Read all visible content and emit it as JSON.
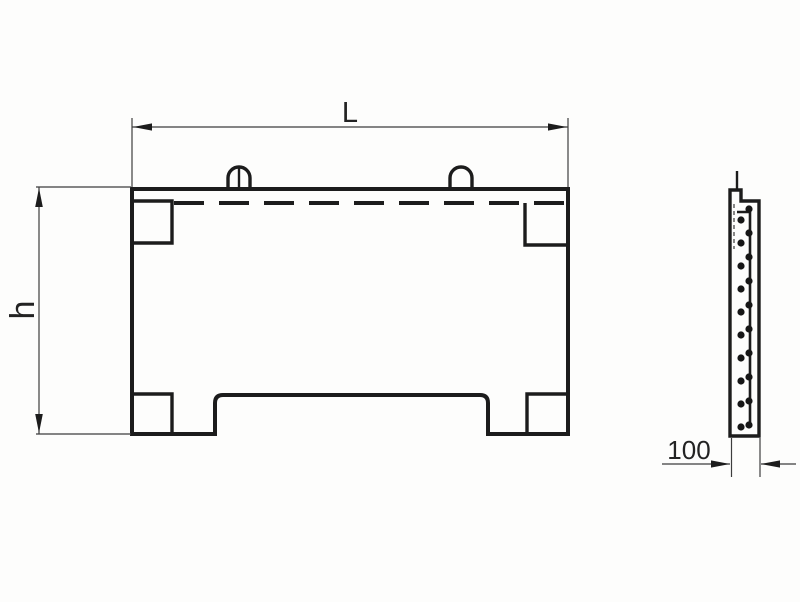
{
  "drawing": {
    "labels": {
      "length": "L",
      "height": "h",
      "width": "100"
    },
    "colors": {
      "line": "#1c1c1c",
      "dim_line": "#3d3d3d",
      "text": "#232323",
      "background": "#fdfdfc"
    },
    "side_view": {
      "rebar_dots": {
        "radius": 3.6,
        "columns": [
          {
            "name": "right-column",
            "x": 749,
            "y_start": 209,
            "step": 24,
            "count": 10
          },
          {
            "name": "left-column",
            "x": 741,
            "y_start": 220,
            "step": 23,
            "count": 10
          }
        ]
      }
    }
  }
}
